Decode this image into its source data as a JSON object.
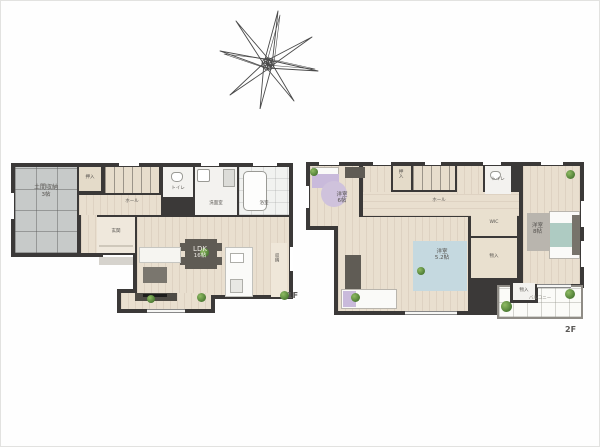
{
  "title": "間取り図",
  "compass": {
    "icon": "hand-drawn-star"
  },
  "floor1": {
    "tag": "1F",
    "rooms": {
      "doma": {
        "name": "土間収納",
        "size": "3帖"
      },
      "oshiire": {
        "name": "押入"
      },
      "hall": {
        "name": "ホール"
      },
      "genkan": {
        "name": "玄関"
      },
      "wc": {
        "name": "トイレ"
      },
      "washroom": {
        "name": "洗面室"
      },
      "bath": {
        "name": "浴室"
      },
      "ldk": {
        "name": "LDK",
        "size": "16帖"
      },
      "pantry": {
        "name": "収納"
      }
    }
  },
  "floor2": {
    "tag": "2F",
    "rooms": {
      "bedroom_a": {
        "name": "洋室",
        "size": "6帖"
      },
      "oshiire": {
        "name": "押入"
      },
      "hall": {
        "name": "ホール"
      },
      "wc": {
        "name": "トイレ"
      },
      "wic": {
        "name": "WIC"
      },
      "storage_mid": {
        "name": "物入"
      },
      "bedroom_b": {
        "name": "洋室",
        "size": "5.2帖"
      },
      "master": {
        "name": "洋室",
        "size": "8帖"
      },
      "storage": {
        "name": "物入"
      },
      "balcony": {
        "name": "バルコニー"
      }
    }
  },
  "colors": {
    "wall": "#3b3938",
    "wood": "#e9dfcf",
    "tile": "#c7cac9",
    "accent_purple": "#c9badb",
    "accent_blue": "#c5d9e0",
    "accent_teal": "#aecbc2",
    "plant_green": "#5d8f3f"
  }
}
